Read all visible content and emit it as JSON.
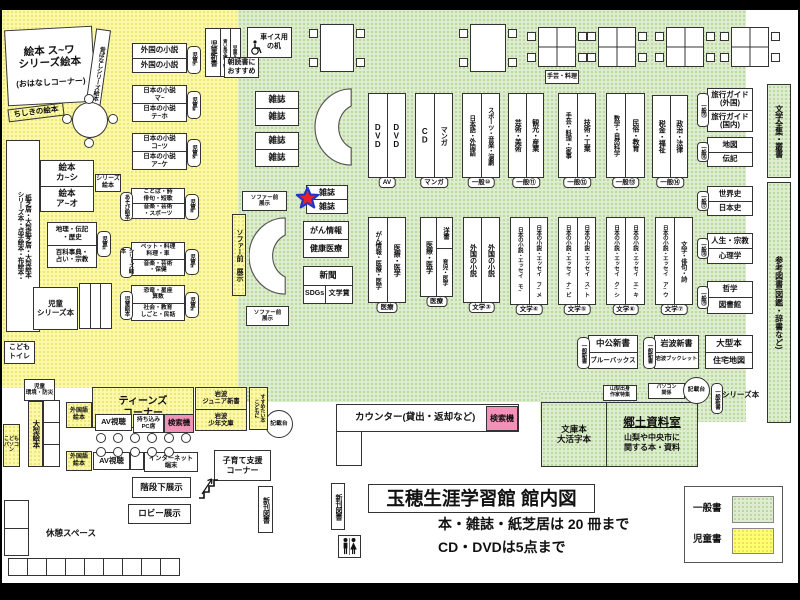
{
  "legend": {
    "general": "一般書",
    "children": "児童書"
  },
  "title_block": {
    "title": "玉穂生涯学習館 館内図",
    "rule1": "本・雑誌・紙芝居は 20 冊まで",
    "rule2": "CD・DVDは5点まで"
  },
  "labels": {
    "ehon_suwa": "絵本 ス~ワ\nシリーズ絵本",
    "ohanashi": "(おはなしコーナー)",
    "mukashi": "昔ばなしシリーズ絵本",
    "chishiki": "ちしきの絵本",
    "tall_left_1": "シリーズ本・点字絵本・布絵本・",
    "tall_left_2": "紙芝居・大型紙芝居・大型絵本",
    "ehon_kashi": "絵本\nカ~シ",
    "ehon_ao": "絵本\nア~オ",
    "series_ehon_badge": "シリーズ\n絵本",
    "chiri": "地理・伝記\n・歴史",
    "hyakka": "百科事典・\n占い・宗教",
    "jidou1": "児童①",
    "jidou2": "児童②",
    "jidou3": "児童③",
    "jidou4": "児童④",
    "jidou5": "児童⑤",
    "jidou6": "児童⑥",
    "jidou7": "児童⑦",
    "jidou_series": "児童\nシリーズ本",
    "kodomo_toilet": "こども\nトイレ",
    "jidou_kankyo": "児童\n環境・防災",
    "ogata_ehon": "大型絵本",
    "kodomo_pc": "こども\nパソコン",
    "gaikoku_shosetsu": "外国の小説",
    "nihon_ma": "日本の小説\nマ~",
    "nihon_teho": "日本の小説\nテ~ホ",
    "nihon_kotsu": "日本の小説\nコ~ツ",
    "nihon_ake": "日本の小説\nア~ケ",
    "kotoba": "ことば・詩\n俳句・短歌",
    "ongaku_sports": "音楽・芸術\n・スポーツ",
    "asobi_ehon": "あそび絵本",
    "pet_ryori": "ペット・料理\n料理・車",
    "ongaku_hoken": "音楽・芸術\n・保健",
    "series_ehon_side": "シリーズ絵本",
    "kyoryu": "恐竜・星座\n算数",
    "shakai": "社会・教育\nしごと・民話",
    "jidou_ehon_side": "児童絵本",
    "jidou_shinsho": "児童新書",
    "aoitori": "青い鳥文庫・他",
    "jidou_bunko": "児童文庫",
    "asadoku": "朝読書に\nおすすめ",
    "kurumaisu": "車イス用\nの机",
    "shugei_ryori": "手芸・料理",
    "zasshi": "雑誌",
    "sofa_mae_sm": "ソファー前\n展示",
    "sofa_mae_v": "ソファー前 展示",
    "gan_joho": "がん情報",
    "kenko_iryo": "健康医療",
    "shinbun": "新聞",
    "sdgs": "SDGs",
    "bungakusho": "文学賞",
    "teens": "ティーンズ\nコーナー",
    "gaikokugo_ehon": "外国語\n絵本",
    "av_shicho": "AV視聴",
    "mochikomi_pc": "持ち込み\nPC席",
    "kensakuki": "検索機",
    "iwanami_jr": "岩波\nジュニア新書",
    "iwanami_shonen": "岩波\n少年文庫",
    "kodomoni_1": "こどもに",
    "kodomoni_2": "すすめたい本",
    "internet": "インターネット\n端末",
    "kosodate": "子育て支援\nコーナー",
    "kaidan": "階段下展示",
    "lobby": "ロビー展示",
    "kyukei": "休憩スペース",
    "shinkan": "新刊図書",
    "counter": "カウンター(貸出・返却など)",
    "kisaidai": "記載台",
    "yamanashi": "山梨出身\n作家特集",
    "pc_kankei": "パソコン\n関係",
    "series_hon": "シリーズ本",
    "ippan_shinsho": "一般新書",
    "chuko": "中公新書",
    "bluebacks": "ブルーバックス",
    "iwanami_shinsho": "岩波新書",
    "iwanami_booklet": "岩波ブックレット",
    "ogata_hon": "大型本",
    "jutaku": "住宅地図",
    "bunko_daikatsuji": "文庫本\n大活字本",
    "kyodo_title": "郷土資料室",
    "kyodo_desc": "山梨や中央市に\n関する本・資料",
    "bungaku_zenshu": "文学全集・叢書",
    "sanko_tosho": "参考図書(図鑑・辞書など)"
  },
  "shelf_units": [
    {
      "x": 368,
      "y": 93,
      "w": 38,
      "h": 85,
      "cols": [
        "DVD",
        "DVD"
      ],
      "badge": "AV"
    },
    {
      "x": 415,
      "y": 93,
      "w": 38,
      "h": 85,
      "cols": [
        "CD",
        "マンガ"
      ],
      "badge": "マンガ"
    },
    {
      "x": 462,
      "y": 93,
      "w": 38,
      "h": 85,
      "cols": [
        "日本語・外国語",
        "スポーツ・音楽・演劇"
      ],
      "badge": "一般⑩"
    },
    {
      "x": 508,
      "y": 93,
      "w": 36,
      "h": 85,
      "cols": [
        "芸術・美術",
        "観光・産業"
      ],
      "badge": "一般⑪"
    },
    {
      "x": 558,
      "y": 93,
      "w": 38,
      "h": 85,
      "cols": [
        "手芸・料理・家事",
        "技術・工業"
      ],
      "badge": "一般⑫"
    },
    {
      "x": 606,
      "y": 93,
      "w": 39,
      "h": 85,
      "cols": [
        "数学・自然科学",
        "民俗・教育"
      ],
      "badge": "一般⑬"
    },
    {
      "x": 652,
      "y": 95,
      "w": 36,
      "h": 83,
      "cols": [
        "税金・福祉",
        "政治・法律"
      ],
      "badge": "一般⑭"
    },
    {
      "x": 368,
      "y": 217,
      "w": 38,
      "h": 86,
      "cols": [
        "がん情報・医療・医学",
        "医療・医学"
      ],
      "badge": "医療"
    },
    {
      "x": 420,
      "y": 217,
      "w": 33,
      "h": 80,
      "cols": [
        "医療・医学",
        "split"
      ],
      "split": [
        "洋書",
        "育児・医学"
      ],
      "badge": "医療"
    },
    {
      "x": 463,
      "y": 217,
      "w": 37,
      "h": 86,
      "cols": [
        "外国の小説",
        "外国の小説"
      ],
      "badge": "文学③"
    },
    {
      "x": 510,
      "y": 217,
      "w": 38,
      "h": 88,
      "cols": [
        "日本の小説・エッセイ モ~",
        "日本の小説・エッセイ フ~メ"
      ],
      "badge": "文学④"
    },
    {
      "x": 558,
      "y": 217,
      "w": 38,
      "h": 88,
      "cols": [
        "日本の小説・エッセイ ナ~ビ",
        "日本の小説・エッセイ ス~ト"
      ],
      "badge": "文学⑤"
    },
    {
      "x": 606,
      "y": 217,
      "w": 39,
      "h": 88,
      "cols": [
        "日本の小説・エッセイ ク~シ",
        "日本の小説・エッセイ エ~キ"
      ],
      "badge": "文学⑥"
    },
    {
      "x": 655,
      "y": 217,
      "w": 38,
      "h": 88,
      "cols": [
        "日本の小説・エッセイ ア~ウ",
        "文学・俳句・詩"
      ],
      "badge": "文学⑦"
    }
  ],
  "right_stack": [
    {
      "y": 88,
      "h": 44,
      "badge": "一般⑮",
      "cells": [
        "旅行ガイド\n(外国)",
        "旅行ガイド\n(国内)"
      ]
    },
    {
      "y": 137,
      "h": 30,
      "badge": "一般⑯",
      "cells": [
        "地図",
        "伝記"
      ]
    },
    {
      "y": 186,
      "h": 30,
      "badge": "一般⑰",
      "cells": [
        "世界史",
        "日本史"
      ]
    },
    {
      "y": 233,
      "h": 31,
      "badge": "一般⑱",
      "cells": [
        "人生・宗教",
        "心理学"
      ]
    },
    {
      "y": 281,
      "h": 33,
      "badge": "一般⑲",
      "cells": [
        "哲学",
        "図書館"
      ]
    }
  ],
  "tables": [
    {
      "x": 320,
      "y": 24,
      "w": 34,
      "h": 48,
      "kind": "plain"
    },
    {
      "x": 470,
      "y": 24,
      "w": 36,
      "h": 48,
      "kind": "plain"
    },
    {
      "x": 538,
      "y": 27,
      "w": 38,
      "h": 40,
      "kind": "quad"
    },
    {
      "x": 598,
      "y": 27,
      "w": 38,
      "h": 40,
      "kind": "quad"
    },
    {
      "x": 666,
      "y": 27,
      "w": 38,
      "h": 40,
      "kind": "quad"
    },
    {
      "x": 731,
      "y": 27,
      "w": 38,
      "h": 40,
      "kind": "quad"
    }
  ],
  "teen_chairs": {
    "rows": [
      {
        "y": 433,
        "x": [
          96,
          113,
          130,
          147,
          164,
          181
        ]
      },
      {
        "y": 447,
        "x": [
          96,
          113,
          130,
          147,
          164
        ]
      }
    ]
  }
}
